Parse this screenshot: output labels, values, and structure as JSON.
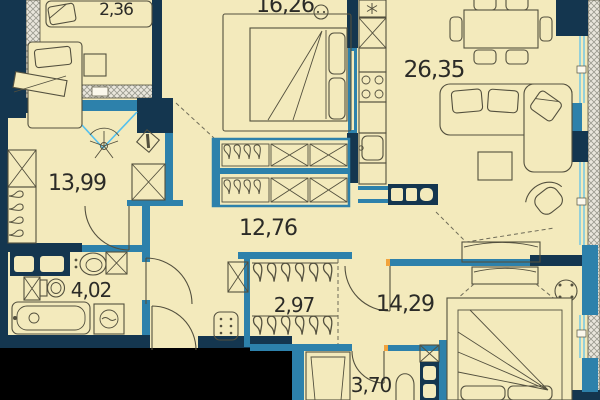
{
  "plan": {
    "type": "apartment-floor-plan",
    "units": "m2",
    "areas": {
      "balcony": "2,36",
      "bedroom_top": "16,26",
      "kitchen_living": "26,35",
      "bedroom_left": "13,99",
      "hall": "12,76",
      "bathroom": "4,02",
      "closet": "2,97",
      "bedroom_right": "14,29",
      "shower_room": "3,70"
    },
    "colors": {
      "background": "#f3eabc",
      "exterior_walls": "#14364f",
      "partitions_windows": "#2d81ab",
      "glazing_doorswing": "#54c0ee",
      "outside_mass": "#000000",
      "hatch_line": "#9a9a8f",
      "door_jamb_marker": "#f2a33c",
      "furniture_line": "#53503e",
      "label_text": "#2b2b27"
    },
    "icons": {
      "fridge": "snowflake-icon",
      "stove": "four-burners-icon",
      "washing_machine": "drum-wave-icon",
      "cabinet": "crossed-box-icon",
      "wardrobe_rod": "hanger-hooks-icon",
      "desk_chair": "five-spoke-chair-icon"
    }
  }
}
